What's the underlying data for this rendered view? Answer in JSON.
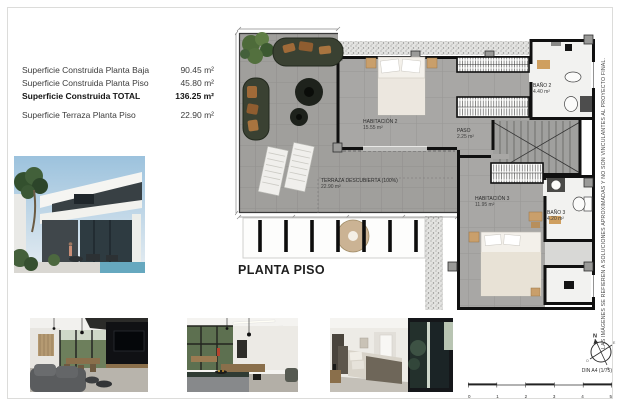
{
  "surface_table": {
    "rows": [
      {
        "label": "Superficie Construida Planta Baja",
        "value": "90.45 m²"
      },
      {
        "label": "Superficie Construida Planta Piso",
        "value": "45.80 m²"
      },
      {
        "label": "Superficie Construida TOTAL",
        "value": "136.25 m²"
      },
      {
        "label": "Superficie Terraza Planta Piso",
        "value": "22.90 m²"
      }
    ]
  },
  "floor_plan": {
    "title": "PLANTA PISO",
    "rooms": {
      "habitacion2": {
        "name": "HABITACIÓN 2",
        "area": "15.55 m²"
      },
      "bano2": {
        "name": "BAÑO 2",
        "area": "4.40 m²"
      },
      "paso": {
        "name": "PASO",
        "area": "2.25 m²"
      },
      "habitacion3": {
        "name": "HABITACIÓN 3",
        "area": "11.95 m²"
      },
      "bano3": {
        "name": "BAÑO 3",
        "area": "4.20 m²"
      },
      "terraza": {
        "name": "TERRAZA DESCUBIERTA (100%)",
        "area": "22.90 m²"
      }
    }
  },
  "sidebar_note": "LAS IMÁGENES SE REFIEREN A SOLUCIONES APROXIMADAS Y NO SON VINCULANTES AL PROYECTO FINAL.",
  "title_block": {
    "paper_scale": "DIN A4 (1/75)",
    "scale_ticks": [
      "0",
      "1",
      "2",
      "3",
      "4",
      "5"
    ],
    "compass": {
      "n": "N",
      "e": "E",
      "s": "S",
      "o": "O"
    }
  },
  "colors": {
    "wall": "#101010",
    "floor_tile": "#a8a7a5",
    "terrace_tile": "#a09f9c",
    "bath_floor": "#f2f2f0",
    "wood_accent": "#c99f6b",
    "sofa_green": "#3a4132",
    "pool_blue": "#66a8bf"
  }
}
